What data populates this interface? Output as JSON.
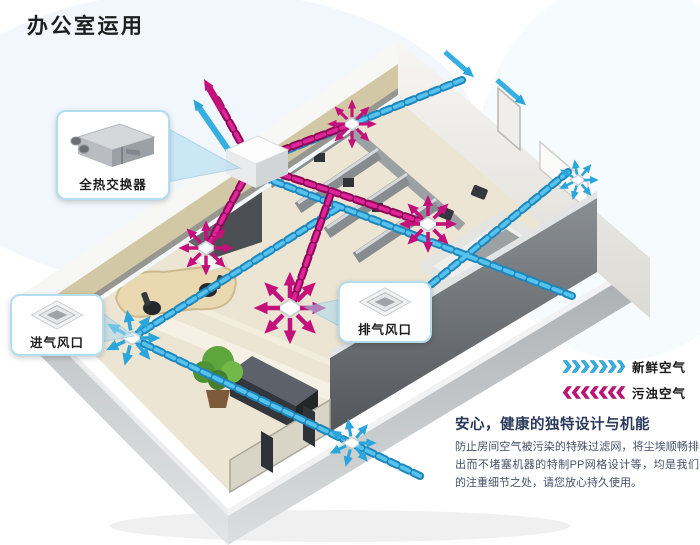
{
  "page": {
    "title": "办公室运用"
  },
  "callouts": {
    "heat_exchanger": {
      "label": "全热交换器"
    },
    "intake_vent": {
      "label": "进气风口"
    },
    "exhaust_vent": {
      "label": "排气风口"
    }
  },
  "legend": {
    "items": [
      {
        "id": "fresh-air",
        "label": "新鲜空气",
        "color": "#35aee2",
        "direction": "right"
      },
      {
        "id": "polluted-air",
        "label": "污浊空气",
        "color": "#c4107a",
        "direction": "left"
      }
    ]
  },
  "description": {
    "heading": "安心，健康的独特设计与机能",
    "body": "防止房间空气被污染的特殊过滤网，将尘埃顺畅排出而不堵塞机器的特制PP网格设计等，均是我们的注重细节之处，请您放心持久使用。"
  },
  "diagram_colors": {
    "fresh_air": "#35aee2",
    "polluted_air": "#c4107a",
    "building_wall": "#c3c6c8",
    "floor": "#ece5d3"
  }
}
